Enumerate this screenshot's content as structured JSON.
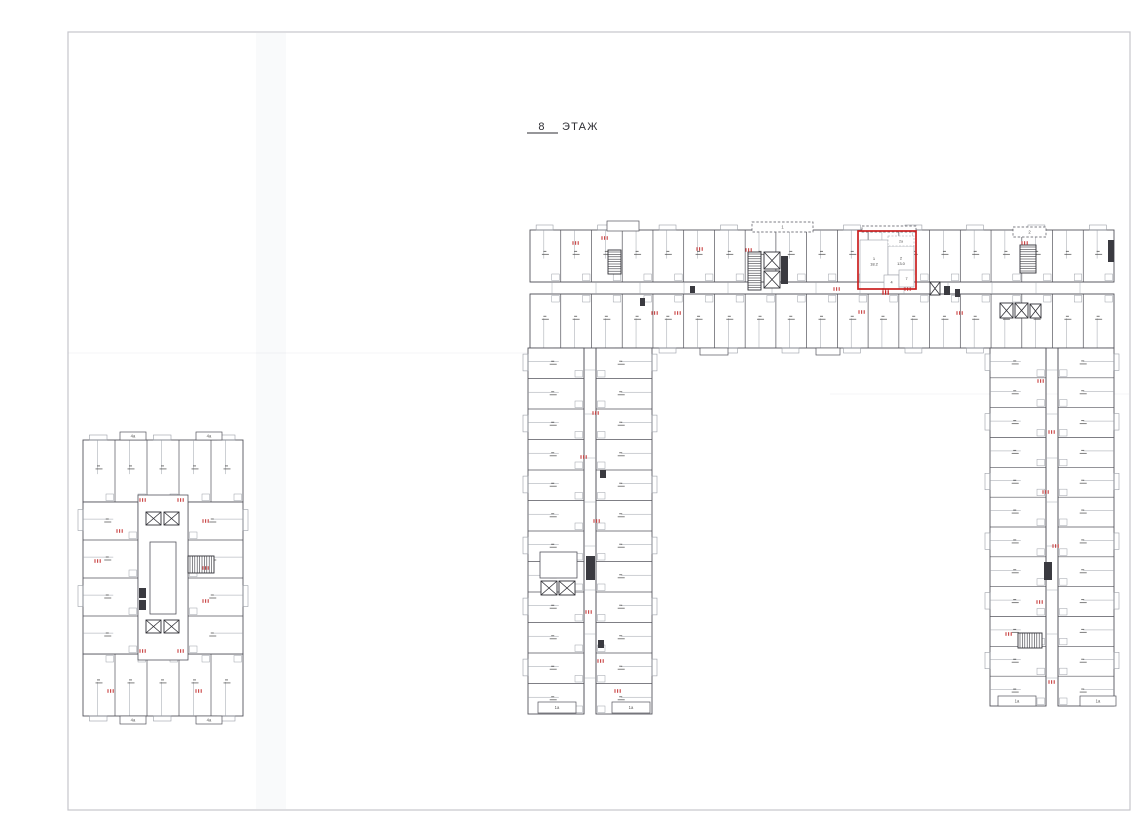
{
  "title": {
    "floor_number": "8",
    "label": "ЭТАЖ"
  },
  "colors": {
    "wall": "#54545c",
    "sub": "#9ca0a8",
    "frame": "#c6c6cc",
    "core_fill": "#3a3a40",
    "highlight": "#cb1f1f",
    "red_marker": "#c84040",
    "crease": "#aeb4c4"
  },
  "sheet": {
    "x": 68,
    "y": 32,
    "w": 1062,
    "h": 778
  },
  "title_pos": {
    "num_x": 542,
    "text_x": 562,
    "y": 130,
    "ul_x1": 527,
    "ul_x2": 558,
    "ul_y": 133
  },
  "creases": {
    "vband": {
      "x": 256,
      "y": 33,
      "w": 30,
      "h": 776
    },
    "lines": [
      [
        68,
        353,
        527,
        353
      ],
      [
        830,
        394,
        1129,
        394
      ]
    ]
  },
  "rows": [
    {
      "x": 530,
      "y": 230,
      "w": 584,
      "h": 52,
      "dir": "h",
      "units": 19,
      "balcony": "top"
    },
    {
      "x": 530,
      "y": 294,
      "w": 584,
      "h": 54,
      "dir": "h",
      "units": 19,
      "balcony": "bottom"
    },
    {
      "x": 528,
      "y": 348,
      "w": 56,
      "h": 366,
      "dir": "v",
      "units": 12,
      "balcony": "left"
    },
    {
      "x": 596,
      "y": 348,
      "w": 56,
      "h": 366,
      "dir": "v",
      "units": 12,
      "balcony": "right"
    },
    {
      "x": 990,
      "y": 348,
      "w": 56,
      "h": 358,
      "dir": "v",
      "units": 12,
      "balcony": "left"
    },
    {
      "x": 1058,
      "y": 348,
      "w": 56,
      "h": 358,
      "dir": "v",
      "units": 12,
      "balcony": "right"
    },
    {
      "x": 83,
      "y": 440,
      "w": 160,
      "h": 62,
      "dir": "h",
      "units": 5,
      "balcony": "top"
    },
    {
      "x": 83,
      "y": 654,
      "w": 160,
      "h": 62,
      "dir": "h",
      "units": 5,
      "balcony": "bottom"
    },
    {
      "x": 83,
      "y": 502,
      "w": 55,
      "h": 152,
      "dir": "v",
      "units": 4,
      "balcony": "left"
    },
    {
      "x": 188,
      "y": 502,
      "w": 55,
      "h": 152,
      "dir": "v",
      "units": 4,
      "balcony": "right"
    }
  ],
  "corridors": [
    {
      "x": 530,
      "y": 282,
      "w": 584,
      "h": 12,
      "dir": "h"
    },
    {
      "x": 584,
      "y": 348,
      "w": 12,
      "h": 366,
      "dir": "v"
    },
    {
      "x": 1046,
      "y": 348,
      "w": 12,
      "h": 358,
      "dir": "v"
    }
  ],
  "cores": [
    {
      "x": 138,
      "y": 495,
      "w": 50,
      "h": 165,
      "kind": "room"
    },
    {
      "x": 146,
      "y": 512,
      "w": 15,
      "h": 13,
      "kind": "elev"
    },
    {
      "x": 164,
      "y": 512,
      "w": 15,
      "h": 13,
      "kind": "elev"
    },
    {
      "x": 150,
      "y": 542,
      "w": 26,
      "h": 72,
      "kind": "room"
    },
    {
      "x": 146,
      "y": 620,
      "w": 15,
      "h": 13,
      "kind": "elev"
    },
    {
      "x": 164,
      "y": 620,
      "w": 15,
      "h": 13,
      "kind": "elev"
    },
    {
      "x": 188,
      "y": 556,
      "w": 26,
      "h": 17,
      "kind": "stair-h"
    },
    {
      "x": 608,
      "y": 250,
      "w": 13,
      "h": 24,
      "kind": "stair-v"
    },
    {
      "x": 748,
      "y": 252,
      "w": 13,
      "h": 38,
      "kind": "stair-v"
    },
    {
      "x": 764,
      "y": 252,
      "w": 16,
      "h": 17,
      "kind": "elev"
    },
    {
      "x": 764,
      "y": 271,
      "w": 16,
      "h": 17,
      "kind": "elev"
    },
    {
      "x": 1020,
      "y": 245,
      "w": 16,
      "h": 28,
      "kind": "stair-v"
    },
    {
      "x": 1000,
      "y": 303,
      "w": 13,
      "h": 15,
      "kind": "elev"
    },
    {
      "x": 1015,
      "y": 303,
      "w": 13,
      "h": 15,
      "kind": "elev"
    },
    {
      "x": 1030,
      "y": 304,
      "w": 11,
      "h": 14,
      "kind": "elev"
    },
    {
      "x": 541,
      "y": 581,
      "w": 16,
      "h": 14,
      "kind": "elev"
    },
    {
      "x": 559,
      "y": 581,
      "w": 16,
      "h": 14,
      "kind": "elev"
    },
    {
      "x": 540,
      "y": 552,
      "w": 37,
      "h": 26,
      "kind": "room"
    },
    {
      "x": 1018,
      "y": 633,
      "w": 24,
      "h": 15,
      "kind": "stair-h"
    },
    {
      "x": 930,
      "y": 282,
      "w": 10,
      "h": 13,
      "kind": "elev"
    }
  ],
  "shafts": [
    {
      "x": 586,
      "y": 556,
      "w": 9,
      "h": 24
    },
    {
      "x": 139,
      "y": 588,
      "w": 7,
      "h": 10
    },
    {
      "x": 139,
      "y": 600,
      "w": 7,
      "h": 10
    },
    {
      "x": 781,
      "y": 256,
      "w": 7,
      "h": 28
    },
    {
      "x": 944,
      "y": 286,
      "w": 6,
      "h": 9
    },
    {
      "x": 955,
      "y": 289,
      "w": 5,
      "h": 8
    },
    {
      "x": 690,
      "y": 286,
      "w": 5,
      "h": 7
    },
    {
      "x": 640,
      "y": 298,
      "w": 5,
      "h": 8
    },
    {
      "x": 1108,
      "y": 240,
      "w": 6,
      "h": 22
    },
    {
      "x": 1044,
      "y": 562,
      "w": 8,
      "h": 18
    },
    {
      "x": 600,
      "y": 470,
      "w": 6,
      "h": 8
    },
    {
      "x": 598,
      "y": 640,
      "w": 6,
      "h": 8
    }
  ],
  "protrusions": [
    {
      "x": 607,
      "y": 221,
      "w": 32,
      "h": 10,
      "dashed": false,
      "label": ""
    },
    {
      "x": 752,
      "y": 222,
      "w": 61,
      "h": 10,
      "dashed": true,
      "label": "1"
    },
    {
      "x": 862,
      "y": 226,
      "w": 54,
      "h": 6,
      "dashed": true,
      "label": ""
    },
    {
      "x": 1013,
      "y": 227,
      "w": 33,
      "h": 10,
      "dashed": true,
      "label": "2"
    },
    {
      "x": 700,
      "y": 348,
      "w": 28,
      "h": 7,
      "dashed": false,
      "label": ""
    },
    {
      "x": 816,
      "y": 348,
      "w": 24,
      "h": 7,
      "dashed": false,
      "label": ""
    },
    {
      "x": 538,
      "y": 702,
      "w": 38,
      "h": 11,
      "dashed": false,
      "label": "1a"
    },
    {
      "x": 612,
      "y": 702,
      "w": 38,
      "h": 11,
      "dashed": false,
      "label": "1a"
    },
    {
      "x": 998,
      "y": 696,
      "w": 38,
      "h": 10,
      "dashed": false,
      "label": "1a"
    },
    {
      "x": 1080,
      "y": 696,
      "w": 36,
      "h": 10,
      "dashed": false,
      "label": "1a"
    },
    {
      "x": 120,
      "y": 432,
      "w": 26,
      "h": 8,
      "dashed": false,
      "label": "4a"
    },
    {
      "x": 196,
      "y": 432,
      "w": 26,
      "h": 8,
      "dashed": false,
      "label": "4a"
    },
    {
      "x": 120,
      "y": 716,
      "w": 26,
      "h": 8,
      "dashed": false,
      "label": "4a"
    },
    {
      "x": 196,
      "y": 716,
      "w": 26,
      "h": 8,
      "dashed": false,
      "label": "4a"
    }
  ],
  "red_markers": [
    [
      576,
      243
    ],
    [
      605,
      238
    ],
    [
      700,
      249
    ],
    [
      749,
      250
    ],
    [
      837,
      289
    ],
    [
      886,
      290
    ],
    [
      908,
      289
    ],
    [
      1025,
      243
    ],
    [
      655,
      313
    ],
    [
      678,
      313
    ],
    [
      862,
      312
    ],
    [
      960,
      313
    ],
    [
      596,
      413
    ],
    [
      584,
      457
    ],
    [
      597,
      521
    ],
    [
      589,
      612
    ],
    [
      601,
      661
    ],
    [
      618,
      691
    ],
    [
      1041,
      381
    ],
    [
      1052,
      432
    ],
    [
      1046,
      492
    ],
    [
      1056,
      546
    ],
    [
      1040,
      602
    ],
    [
      1009,
      634
    ],
    [
      1052,
      682
    ],
    [
      143,
      500
    ],
    [
      181,
      500
    ],
    [
      120,
      531
    ],
    [
      206,
      521
    ],
    [
      98,
      561
    ],
    [
      206,
      568
    ],
    [
      206,
      601
    ],
    [
      143,
      651
    ],
    [
      181,
      651
    ],
    [
      111,
      691
    ],
    [
      199,
      691
    ]
  ],
  "highlight": {
    "x": 858,
    "y": 231,
    "w": 58,
    "h": 58,
    "rooms": [
      {
        "label": "1",
        "area": "18.2",
        "x": 860,
        "y": 240,
        "w": 28,
        "h": 42
      },
      {
        "label": "2",
        "area": "13.0",
        "x": 888,
        "y": 246,
        "w": 26,
        "h": 29
      }
    ],
    "small_rooms": [
      {
        "label": "4",
        "x": 884,
        "y": 275,
        "w": 15,
        "h": 14
      },
      {
        "label": "7",
        "x": 899,
        "y": 270,
        "w": 15,
        "h": 17
      }
    ],
    "balcony": {
      "label": "2a",
      "x": 888,
      "y": 236,
      "w": 26,
      "h": 10
    },
    "marker": [
      886,
      293
    ]
  }
}
